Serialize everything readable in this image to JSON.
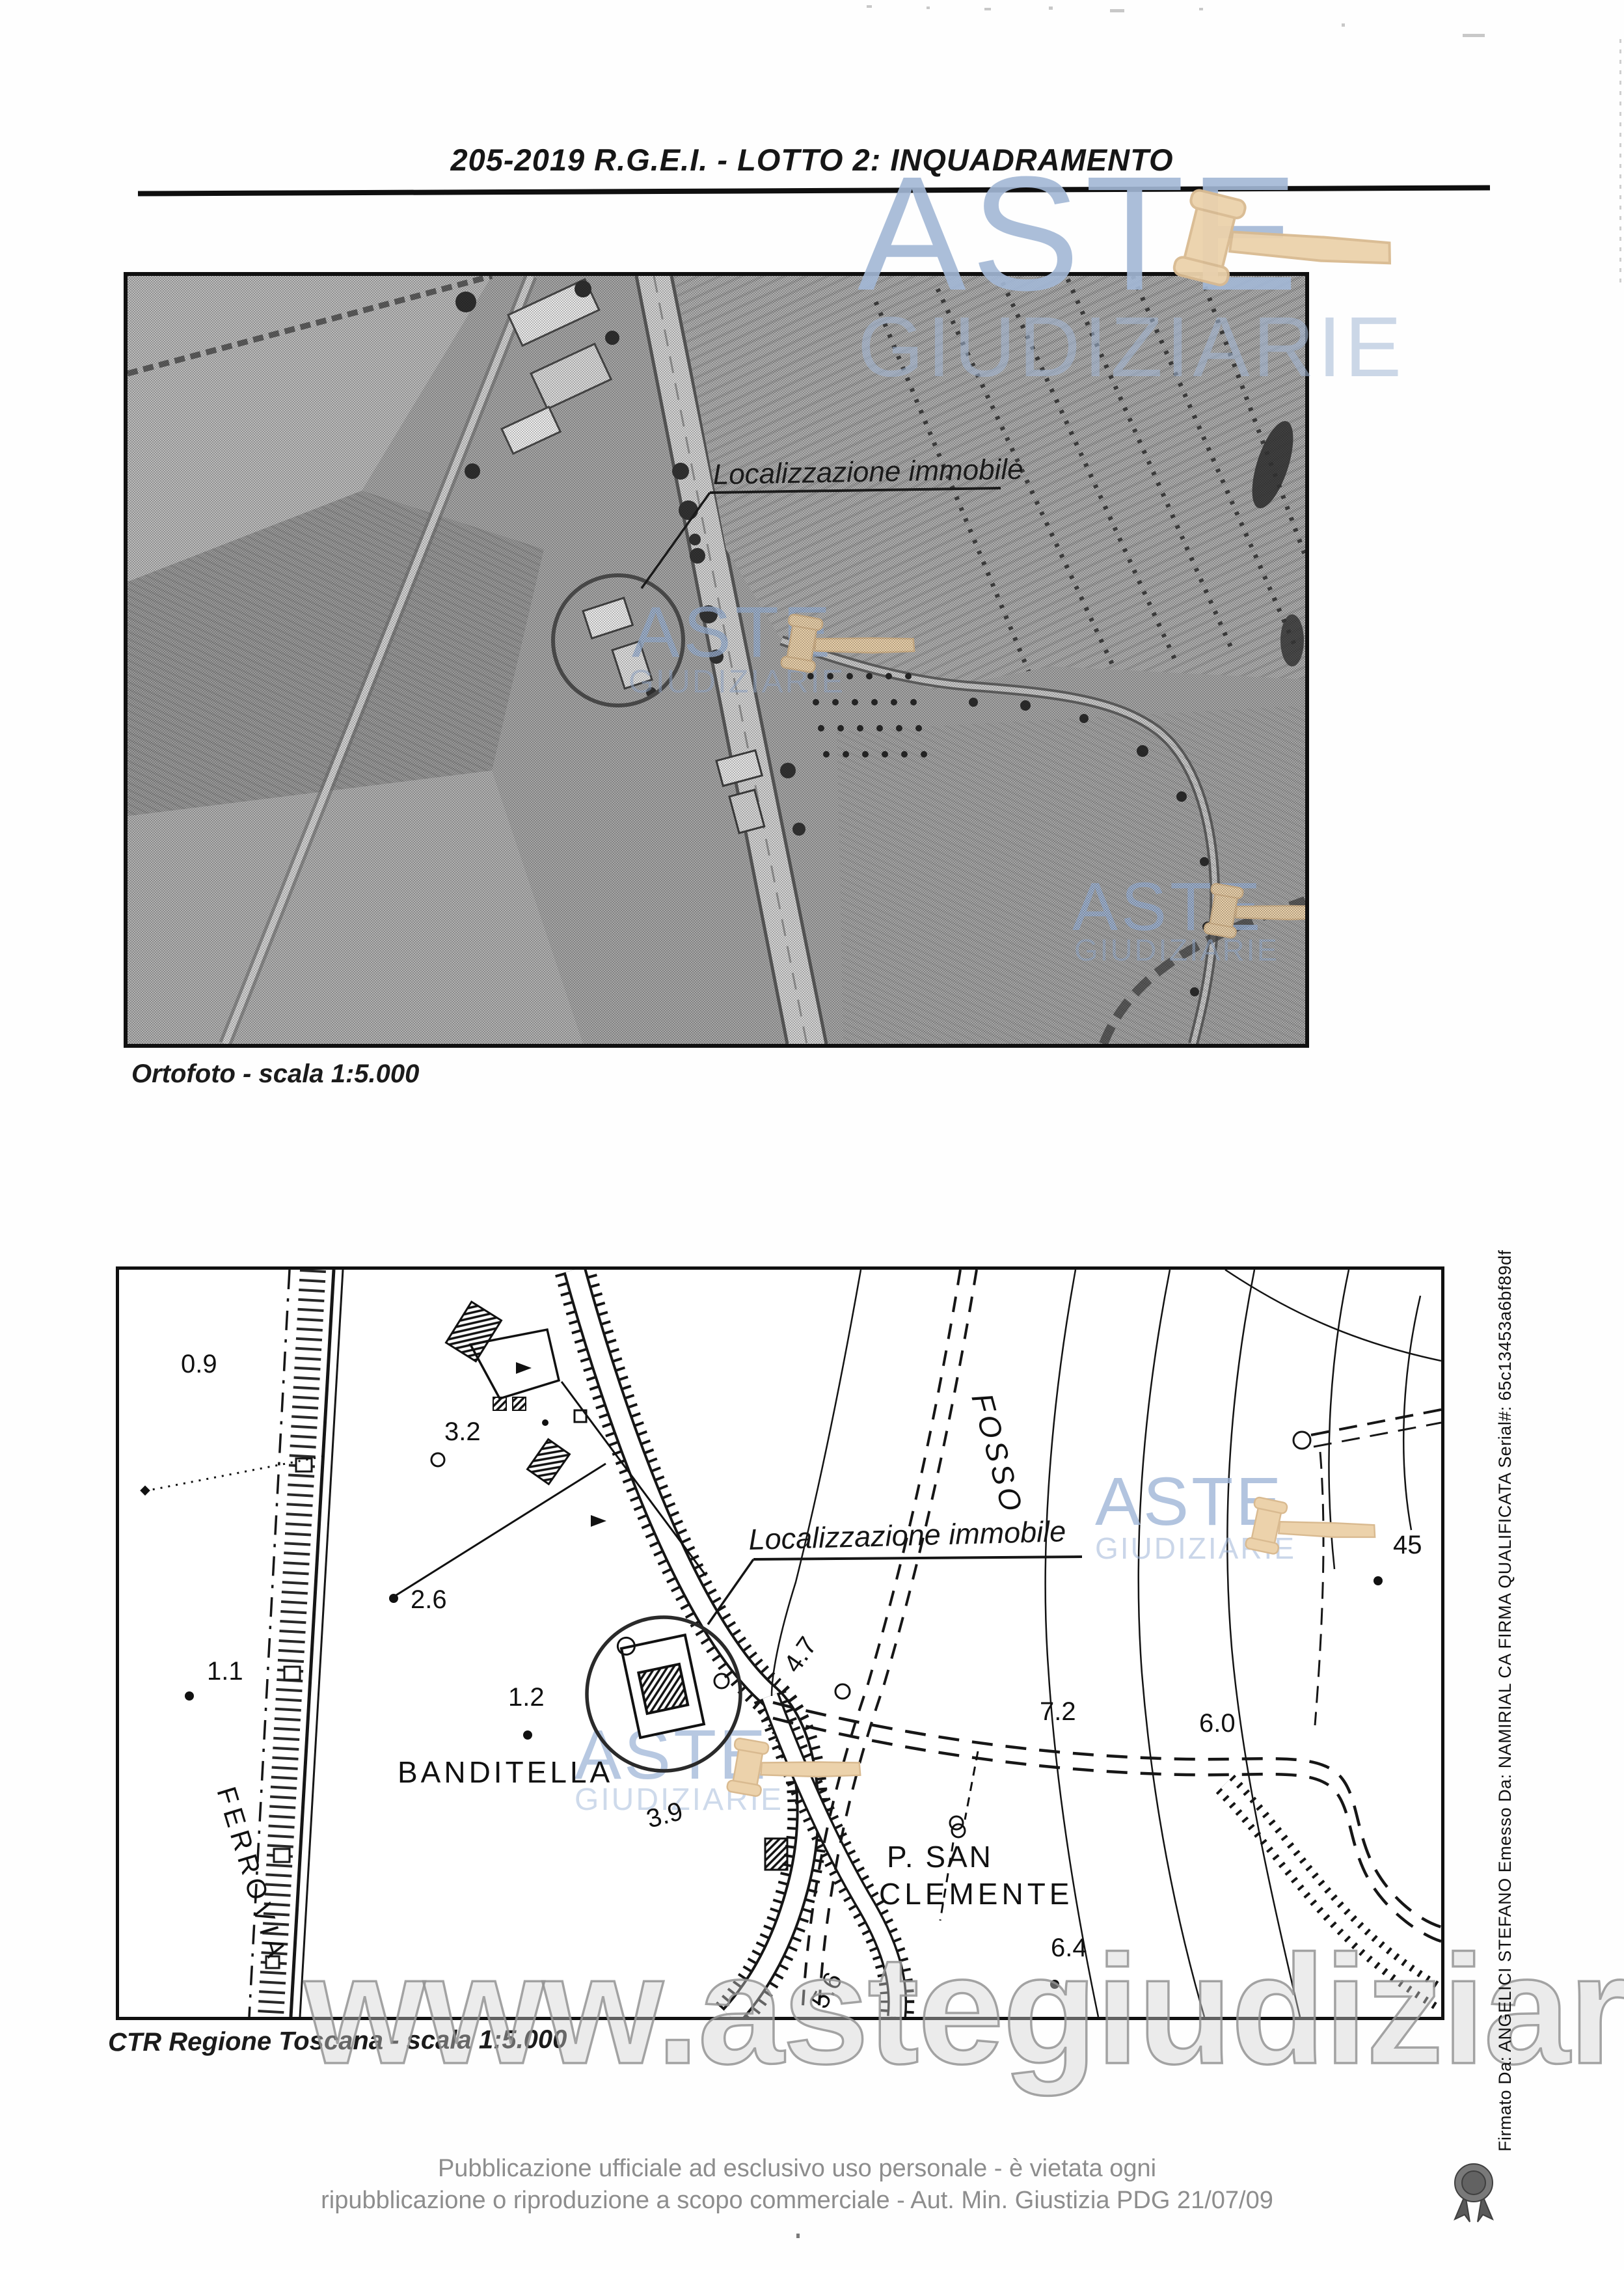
{
  "page": {
    "title": "205-2019 R.G.E.I.  - LOTTO 2: INQUADRAMENTO",
    "footer": {
      "line1": "Pubblicazione ufficiale ad esclusivo uso personale - è vietata ogni",
      "line2": "ripubblicazione o riproduzione a scopo commerciale - Aut. Min. Giustizia PDG 21/07/09"
    },
    "signature_vertical": "Firmato Da: ANGELICI STEFANO Emesso Da: NAMIRIAL CA FIRMA QUALIFICATA Serial#: 65c13453a6bf89df"
  },
  "watermarks": {
    "brand_line1": "ASTE",
    "brand_line2": "GIUDIZIARIE",
    "site_url": "www.astegiudiziarie.it",
    "brand_color": "#9db6d7",
    "gavel_color": "#ecd2ab",
    "url_color": "#bdbdbd"
  },
  "ortofoto": {
    "caption": "Ortofoto - scala 1:5.000",
    "annotation_label": "Localizzazione immobile"
  },
  "ctr": {
    "caption": "CTR Regione Toscana - scala 1:5.000",
    "annotation_label": "Localizzazione immobile",
    "place_labels": {
      "banditella": "BANDITELLA",
      "ferrovia": "FERROVIA",
      "fosso": "FOSSO",
      "san_clemente_1": "P.  SAN",
      "san_clemente_2": "CLEMENTE"
    },
    "spot_heights": {
      "h09": "0.9",
      "h32": "3.2",
      "h26": "2.6",
      "h11": "1.1",
      "h12": "1.2",
      "h47": "4.7",
      "h39": "3.9",
      "h56": "5.6",
      "h72": "7.2",
      "h60": "6.0",
      "h64": "6.4",
      "h45": "45"
    }
  }
}
